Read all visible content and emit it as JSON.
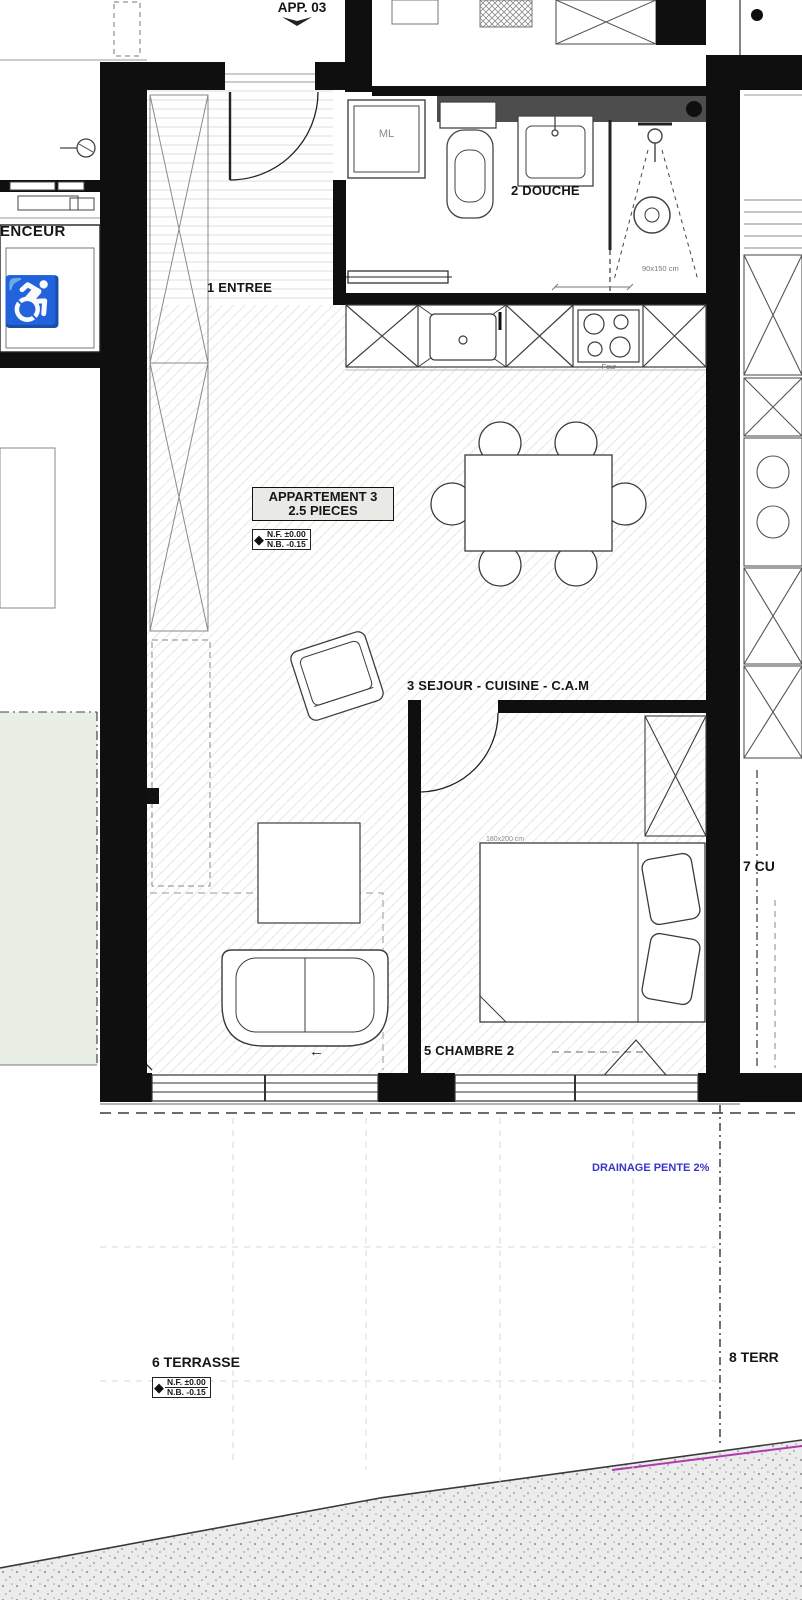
{
  "colors": {
    "accent-blue": "#3a35c9",
    "wheelchair-blue": "#1d4e9e",
    "magenta": "#b13ab1",
    "green-area": "#e9efe5",
    "label-bg": "#e9e9e6",
    "wall": "#0f0f0f",
    "gray-strip": "#4d4d4d"
  },
  "header": {
    "app": "APP. 03"
  },
  "rooms": {
    "elevator": "ENCEUR",
    "entree": "1 ENTREE",
    "douche": "2 DOUCHE",
    "sejour": "3 SEJOUR - CUISINE - C.A.M",
    "chambre": "5 CHAMBRE 2",
    "terrasse": "6 TERRASSE",
    "cuisine_neighbor": "7 CU",
    "terrasse_neighbor": "8 TERR"
  },
  "annotations": {
    "drainage": "DRAINAGE PENTE 2%",
    "washing_machine": "ML",
    "oven": "Four",
    "shower_dim": "90x150 cm",
    "bed_dim": "160x200 cm"
  },
  "apartment_box": {
    "line1": "APPARTEMENT 3",
    "line2": "2.5 PIECES"
  },
  "level_markers": {
    "apartment": {
      "nf": "N.F. ±0.00",
      "nb": "N.B. -0.15"
    },
    "terrace": {
      "nf": "N.F. ±0.00",
      "nb": "N.B. -0.15"
    }
  },
  "glyphs": {
    "arrow_left": "←",
    "diamond": "◆",
    "wheelchair": "♿"
  }
}
